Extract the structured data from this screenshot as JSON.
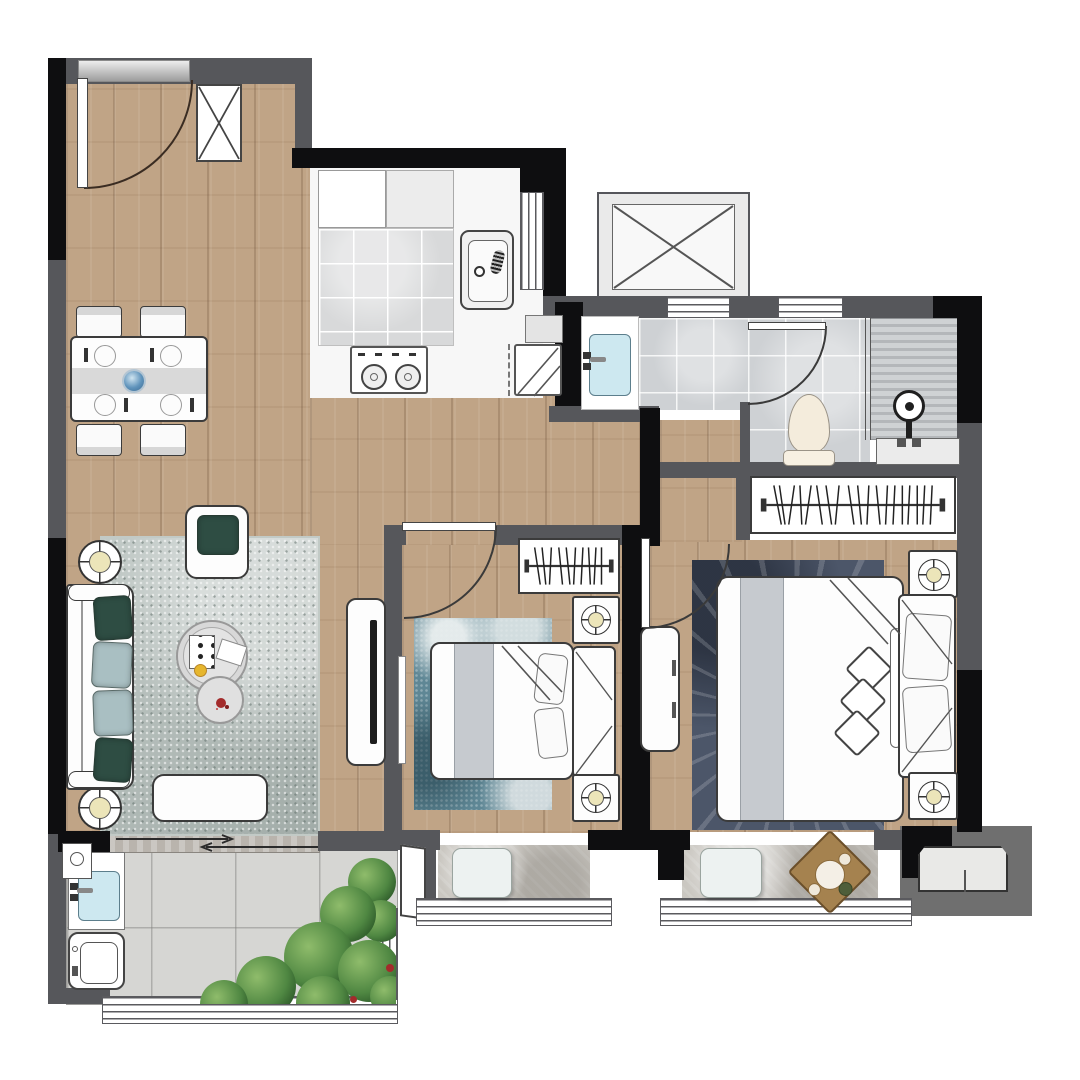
{
  "meta": {
    "kind": "apartment-floor-plan",
    "view": "top-down-render",
    "text_labels": "none"
  },
  "colors": {
    "wallG": "#56575b",
    "wallB": "#0e0e10",
    "wood": "#c0a486",
    "tileK": "#d8d9da",
    "tileB": "#ced1d4",
    "tileBal": "#d6d6d3",
    "stone": "#cac7c1",
    "rugLiving": "#aeb9b5",
    "rugBed2": "#5f8795",
    "rugMaster": "#4c5669",
    "furLine": "#3b3b3b",
    "furFill": "#fdfdfd",
    "cushionGreen": "#2e4d43",
    "cushionBlue": "#a9bfc2",
    "lampY": "#ece5b9",
    "sinkBlue": "#cde8f0",
    "plantG": "#4f8742",
    "plantD": "#2f5c2a",
    "toiletCream": "#f4ecdc",
    "trayWood": "#a5824f",
    "acPlatform": "#6f6f6f",
    "thresholdSilver": "#c7c7c7",
    "blanket": "#c6cacf",
    "flowerBlue": "#5f93bb",
    "accentYellow": "#e6b62e",
    "accentRed": "#a32b2b"
  },
  "rooms": [
    {
      "id": "entry-dining",
      "floor": "wood",
      "items": [
        "entry-door",
        "entry-threshold",
        "shoe-cabinet",
        "dining-table",
        "dining-chairs",
        "table-runner",
        "flower-centerpiece"
      ]
    },
    {
      "id": "kitchen",
      "floor": "tile",
      "items": [
        "upper-cabinet",
        "countertop",
        "kitchen-sink",
        "cooktop-2-burner",
        "refrigerator",
        "kitchen-window"
      ]
    },
    {
      "id": "elevator-shaft",
      "floor": "none",
      "items": [
        "shaft-x-symbol"
      ]
    },
    {
      "id": "wash-area",
      "floor": "tile",
      "items": [
        "vanity-basin",
        "faucet"
      ]
    },
    {
      "id": "bathroom",
      "floor": "tile",
      "items": [
        "bathroom-door",
        "toilet",
        "shower-head",
        "shower-bench",
        "glass-partition",
        "windows"
      ]
    },
    {
      "id": "living-room",
      "floor": "wood",
      "items": [
        "sofa",
        "sofa-pillows",
        "floor-lamp-top",
        "floor-lamp-bottom",
        "armchair",
        "coffee-table",
        "side-table",
        "ottoman-bench",
        "tv-cabinet",
        "tv",
        "area-rug",
        "sliding-door-to-balcony"
      ]
    },
    {
      "id": "bedroom-2",
      "floor": "wood",
      "items": [
        "door",
        "wardrobe-hanger-rail",
        "double-bed",
        "headboard",
        "pillows",
        "nightstand-lamps",
        "teal-rug",
        "wall-mirror",
        "bay-window-cushion"
      ]
    },
    {
      "id": "master-bedroom",
      "floor": "wood",
      "items": [
        "door",
        "wardrobe-hanger-rail",
        "dresser",
        "double-bed",
        "headboard",
        "pillows",
        "throw-diamonds",
        "nightstand-lamps",
        "dark-rug",
        "bay-window-cushion",
        "tea-tray",
        "ac-outdoor-unit"
      ]
    },
    {
      "id": "balcony",
      "floor": "tile",
      "items": [
        "laundry-counter",
        "laundry-sink",
        "washing-machine",
        "floor-drain",
        "plants",
        "window-band"
      ]
    }
  ]
}
